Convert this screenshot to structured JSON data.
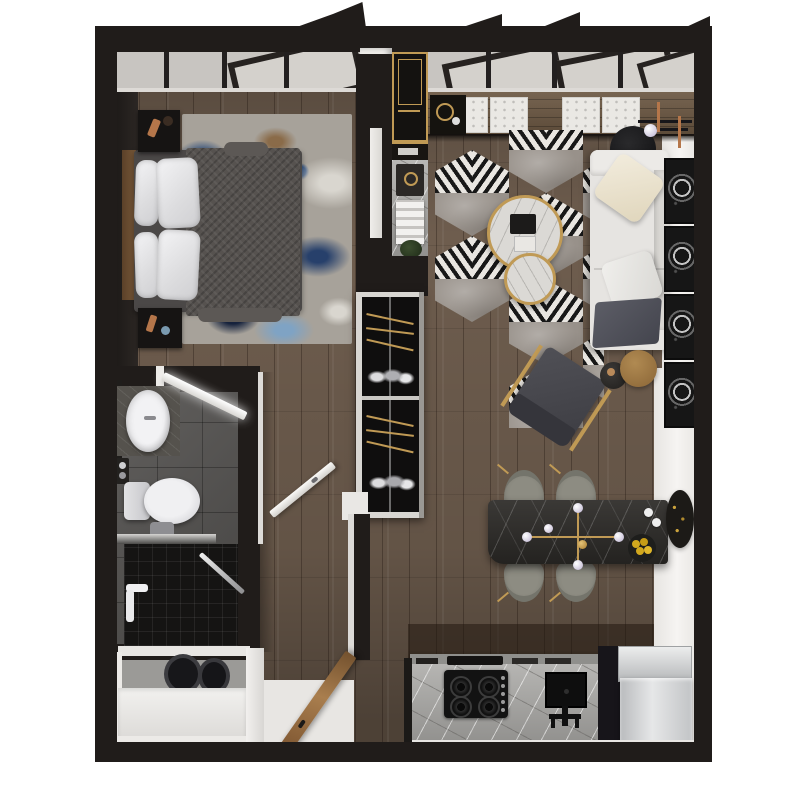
{
  "meta": {
    "kind": "3d-rendered-floor-plan",
    "view": "top-down",
    "apartment": "studio-one-bedroom"
  },
  "palette": {
    "wall": "#201c1a",
    "wall-2": "#2a2522",
    "wood": "#6e5d4e",
    "wood-line": "#463a31",
    "glass": "#c8c5c1",
    "trim-white": "#efedea",
    "wall-white": "#f3f1ef",
    "gold": "#c09a55",
    "sofa-white": "#e6e4e1",
    "cream": "#ece4d0",
    "throw": "#545560",
    "hex-gray": "#98918a",
    "stripe-dark": "#181818",
    "stripe-light": "#e9e6e1",
    "marble-light": "#dbd9d5",
    "marble-counter": "#a9a8a5",
    "marble-dining": "#302e2b",
    "tile": "#595755",
    "shower": "#151413",
    "steel": "#c6c8ca",
    "chair-green": "#8d8c82",
    "lemon": "#d2a81e",
    "copper": "#b5764a",
    "plant": "#2f3d26",
    "blanket": "#56524f",
    "door-wood": "#9a7244"
  },
  "rooms": [
    {
      "id": "bedroom",
      "furniture": [
        "double-bed",
        "wood-headboard",
        "white-pillows",
        "dark-gray-blanket",
        "nightstand-top",
        "nightstand-bottom",
        "abstract-blue-rug",
        "casement-windows"
      ]
    },
    {
      "id": "living-room",
      "furniture": [
        "window-bench-with-tufted-cushions",
        "serving-tray",
        "floor-lamp",
        "black-round-side-table",
        "white-sofa",
        "cream-pillow",
        "white-pillow",
        "dark-throw",
        "hexagon-chevron-rug",
        "marble-coffee-table-large",
        "marble-coffee-table-small",
        "book-stack",
        "gold-frame-armchair",
        "dark-drum-side-table",
        "wood-drum-side-table",
        "leaning-wall-art-frames"
      ]
    },
    {
      "id": "dining-area",
      "furniture": [
        "dark-stone-dining-table",
        "four-upholstered-chairs",
        "gold-sputnik-chandelier",
        "fruit-bowl-lemons",
        "espresso-cups",
        "oval-wall-art"
      ]
    },
    {
      "id": "kitchen",
      "furniture": [
        "stone-countertop",
        "four-burner-gas-cooktop",
        "undermount-sink",
        "black-faucet",
        "stainless-refrigerator",
        "tall-black-cabinet"
      ]
    },
    {
      "id": "entry-niche",
      "furniture": [
        "gold-framed-bar-cabinet",
        "stone-counter-strip",
        "white-appliance-stack",
        "potted-plant"
      ]
    },
    {
      "id": "wardrobe-closet",
      "furniture": [
        "white-framed-wardrobe",
        "brass-hanging-rails",
        "hanging-clothes"
      ]
    },
    {
      "id": "bathroom",
      "furniture": [
        "stone-vanity",
        "oval-vessel-sink",
        "mirror-ledge",
        "toilet",
        "glass-partition",
        "black-tiled-shower",
        "shower-set",
        "squeegee"
      ]
    },
    {
      "id": "laundry-closet",
      "furniture": [
        "stacked-front-load-washer-dryer",
        "white-cabinetry"
      ]
    },
    {
      "id": "entry",
      "furniture": [
        "open-wood-entry-door",
        "white-threshold"
      ]
    }
  ],
  "counts": {
    "bed_pillows": 4,
    "bench_cushions": 4,
    "wall_frames": 4,
    "dining_chairs": 4,
    "cooktop_burners": 4,
    "coffee_tables": 2,
    "hex_rug_tiles": 9
  }
}
